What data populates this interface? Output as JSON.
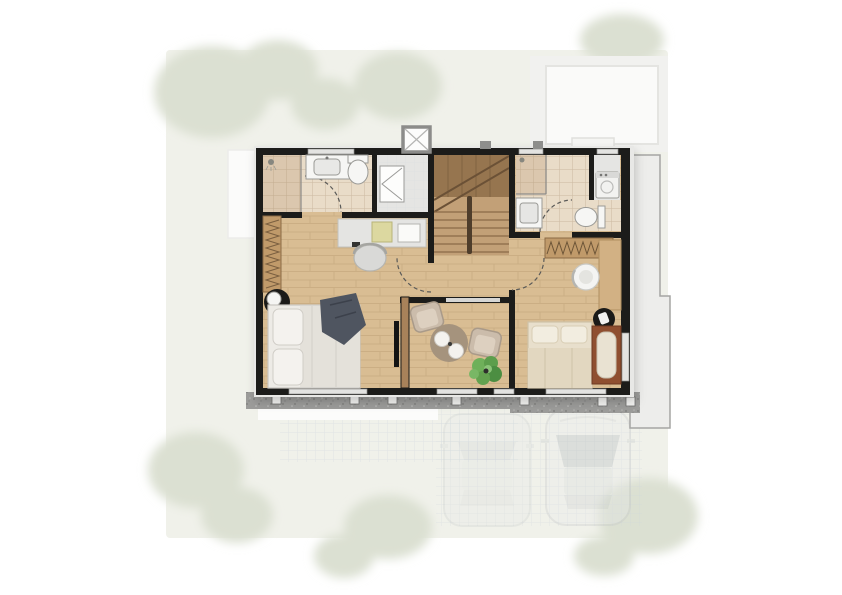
{
  "scene": {
    "type": "architectural-floor-plan",
    "floor": "upper-floor",
    "rooms": [
      {
        "id": "master-bathroom",
        "features": [
          "shower",
          "vanity-sink",
          "toilet",
          "door"
        ]
      },
      {
        "id": "walk-in-closet",
        "features": [
          "bifold-doors"
        ]
      },
      {
        "id": "staircase",
        "features": [
          "upper-landing",
          "treads",
          "center-railing"
        ]
      },
      {
        "id": "bathroom-2",
        "features": [
          "shower",
          "sink",
          "toilet",
          "door"
        ]
      },
      {
        "id": "laundry-niche",
        "features": [
          "washing-machine"
        ]
      },
      {
        "id": "master-bedroom",
        "features": [
          "double-bed",
          "pillows",
          "dark-throw",
          "wardrobe-hangers",
          "desk",
          "desk-chair",
          "round-nightstand",
          "lamp",
          "tv-panel",
          "door"
        ]
      },
      {
        "id": "family-area",
        "features": [
          "armchair",
          "armchair",
          "round-rug",
          "poufs",
          "plant",
          "interior-window"
        ]
      },
      {
        "id": "bedroom-2",
        "features": [
          "single-bed",
          "wardrobe-hangers",
          "desk",
          "round-chair",
          "black-stool",
          "bench-daybed",
          "door"
        ]
      }
    ],
    "outdoor": {
      "vehicles": [
        {
          "type": "car"
        },
        {
          "type": "car"
        }
      ],
      "trees": true,
      "terrace_grid": true,
      "roof_ledge_right": true,
      "roof_block_top_right": true,
      "vent_shaft_top": true,
      "concrete_edge_bottom": true
    }
  },
  "colors": {
    "wall": "#1c1c1a",
    "window": "#e3e3e1",
    "wood": "#d9bd93",
    "wood_line": "#cbae84",
    "tile": "#e9dcc8",
    "tile_shower": "#dbc7ae",
    "gray_floor": "#e5e5e3",
    "fixture": "#f6f6f4",
    "fixture_border": "#9a9a96",
    "door": "#5a5a58",
    "glass": "#8a8a88",
    "concrete": "#9c9c9a",
    "post": "#f5f5f3",
    "roof": "#ededeb",
    "roof_border": "#a5a5a3",
    "garden": "#f0f1ea",
    "tree": "#dbe0d2",
    "linen": "#edebe6",
    "linen_border": "#c9c6c0",
    "throw": "#4f5560",
    "wardrobe_wood": "#c09a6a",
    "stair_dark": "#8f6f4c",
    "stair_tread": "#8a6a47",
    "rug": "#a5937d",
    "plant": "#63a24f",
    "cream_bed": "#e8dfcc",
    "bench_wood": "#8f4f30",
    "tv": "#141414",
    "black_item": "#1a1a18",
    "car_body": "#e4e6e7",
    "car_glass": "#a7aeb5",
    "grid_line": "#ccd3dc",
    "desk": "#e4e4e2"
  }
}
